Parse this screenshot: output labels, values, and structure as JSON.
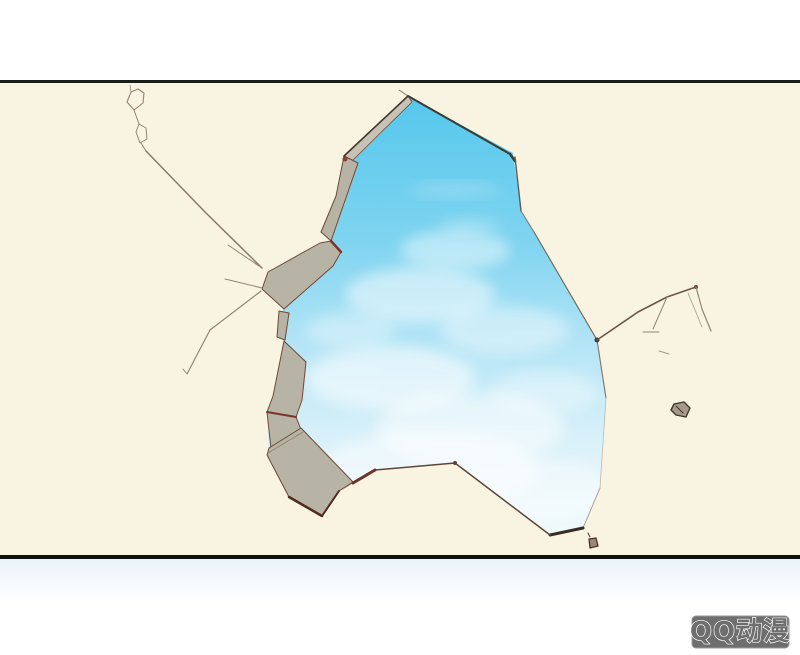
{
  "watermark": {
    "label": "QQ动漫"
  },
  "colors": {
    "page_bg": "#ffffff",
    "panel_bg": "#f9f4e1",
    "frame_line_top": "#1c1c18",
    "frame_line_bottom": "#101010",
    "debris_fill": "#b7b4a6",
    "debris_fill_light": "#c6c2b4",
    "debris_edge": "#6a4a3a",
    "accent_red": "#7a352a",
    "crack": "#948571",
    "cloud": "#ffffff",
    "sky_stops": [
      "#55c7ec",
      "#7fd4f0",
      "#b8e6f6",
      "#ddf2fa",
      "#f0fafd"
    ],
    "band_stops": [
      "#e9f4fa",
      "#ffffff"
    ],
    "watermark_bg": "#6e6e6e",
    "watermark_border": "#9a9a9a",
    "watermark_text": "#ffffff"
  },
  "scene": {
    "hole_points": "410,97 513,153 521,211 534,232 597,340 606,398 600,488 583,528 550,535 455,463 375,470 353,483 339,491 322,516 290,497 268,452 268,412 273,396 284,341 279,337 283,309 333,266 331,241 341,212 344,157",
    "sky_rect": {
      "x": 250,
      "y": 90,
      "w": 370,
      "h": 460
    },
    "clouds": [
      {
        "cx": 455,
        "cy": 190,
        "rx": 45,
        "ry": 5,
        "o": 0.3
      },
      {
        "cx": 470,
        "cy": 225,
        "rx": 30,
        "ry": 6,
        "o": 0.3
      },
      {
        "cx": 455,
        "cy": 250,
        "rx": 55,
        "ry": 20,
        "o": 0.45
      },
      {
        "cx": 420,
        "cy": 295,
        "rx": 75,
        "ry": 28,
        "o": 0.5
      },
      {
        "cx": 505,
        "cy": 330,
        "rx": 65,
        "ry": 24,
        "o": 0.4
      },
      {
        "cx": 350,
        "cy": 330,
        "rx": 45,
        "ry": 18,
        "o": 0.35
      },
      {
        "cx": 390,
        "cy": 378,
        "rx": 85,
        "ry": 32,
        "o": 0.55
      },
      {
        "cx": 545,
        "cy": 392,
        "rx": 55,
        "ry": 22,
        "o": 0.35
      },
      {
        "cx": 470,
        "cy": 428,
        "rx": 95,
        "ry": 36,
        "o": 0.5
      },
      {
        "cx": 430,
        "cy": 470,
        "rx": 110,
        "ry": 40,
        "o": 0.45
      },
      {
        "cx": 530,
        "cy": 490,
        "rx": 90,
        "ry": 32,
        "o": 0.4
      }
    ],
    "shapes": [
      {
        "t": "pg",
        "n": "debris-polygon",
        "p": "408,96 412,102 352,161 344,156",
        "f": "debris_fill_light",
        "s": "debris_edge",
        "w": 0.8
      },
      {
        "t": "pg",
        "n": "debris-polygon",
        "p": "344,156 358,163 341,212 331,241 321,232 336,196",
        "f": "debris_fill",
        "s": "debris_edge",
        "w": 1
      },
      {
        "t": "pg",
        "n": "debris-polygon",
        "p": "331,241 341,252 333,266 284,309 262,289 268,272 320,243",
        "f": "debris_fill",
        "s": "debris_edge",
        "w": 1
      },
      {
        "t": "pg",
        "n": "debris-polygon",
        "p": "279,311 289,313 285,340 277,337",
        "f": "debris_fill",
        "s": "debris_edge",
        "w": 1
      },
      {
        "t": "pg",
        "n": "debris-polygon",
        "p": "284,341 306,362 302,400 296,417 267,412 273,396",
        "f": "debris_fill",
        "s": "debris_edge",
        "w": 1
      },
      {
        "t": "pg",
        "n": "debris-polygon",
        "p": "267,412 296,417 304,437 271,449",
        "f": "debris_fill",
        "s": "debris_edge",
        "w": 1
      },
      {
        "t": "pg",
        "n": "debris-polygon",
        "p": "269,448 301,428 353,482 339,491 322,516 289,497 267,455",
        "f": "debris_fill",
        "s": "debris_edge",
        "w": 1
      },
      {
        "t": "pg",
        "n": "debris-wedge",
        "p": "353,482 372,470 341,491",
        "f": "accent_red",
        "o": 0.85
      },
      {
        "t": "ln",
        "n": "debris-crease",
        "p": [
          268,
          453,
          303,
          432
        ],
        "s": "crack",
        "w": 1
      },
      {
        "t": "ln",
        "n": "hole-edge",
        "p": [
          399,
          90,
          408,
          96
        ],
        "sx": "#8a7a68",
        "w": 1
      },
      {
        "t": "ln",
        "n": "hole-edge",
        "p": [
          408,
          96,
          510,
          154
        ],
        "sx": "#3f3a33",
        "w": 2
      },
      {
        "t": "ln",
        "n": "hole-edge-tick",
        "p": [
          510,
          154,
          515,
          161
        ],
        "sx": "#3f3a33",
        "w": 2.5
      },
      {
        "t": "ln",
        "n": "hole-edge",
        "p": [
          515,
          157,
          521,
          211
        ],
        "sx": "#6b5648",
        "w": 1.4
      },
      {
        "t": "ln",
        "n": "hole-edge",
        "p": [
          521,
          211,
          534,
          232
        ],
        "sx": "#8a7664",
        "w": 1.1
      },
      {
        "t": "ln",
        "n": "hole-edge",
        "p": [
          534,
          232,
          597,
          340
        ],
        "sx": "#7d6853",
        "w": 1.2
      },
      {
        "t": "ln",
        "n": "hole-edge",
        "p": [
          597,
          340,
          606,
          398
        ],
        "sx": "#8d7a66",
        "w": 1.2
      },
      {
        "t": "ln",
        "n": "hole-edge",
        "p": [
          606,
          398,
          600,
          488
        ],
        "sx": "#c3b6a6",
        "w": 0.8
      },
      {
        "t": "ln",
        "n": "hole-edge",
        "p": [
          600,
          488,
          583,
          528
        ],
        "sx": "#b3a290",
        "w": 1
      },
      {
        "t": "ln",
        "n": "hole-edge",
        "p": [
          583,
          528,
          550,
          535
        ],
        "sx": "#3a2b24",
        "w": 3
      },
      {
        "t": "pl",
        "n": "hole-edge",
        "p": "550,535 455,463 375,470",
        "sx": "#5f4537",
        "w": 1.5
      },
      {
        "t": "ln",
        "n": "hole-edge",
        "p": [
          375,
          470,
          353,
          483
        ],
        "sx": "#6e3226",
        "w": 3
      },
      {
        "t": "ln",
        "n": "hole-edge",
        "p": [
          408,
          96,
          344,
          156
        ],
        "sx": "#46362e",
        "w": 1.6
      },
      {
        "t": "ln",
        "n": "debris-accent",
        "p": [
          331,
          241,
          341,
          252
        ],
        "s": "accent_red",
        "w": 2.5
      },
      {
        "t": "ln",
        "n": "debris-accent",
        "p": [
          267,
          412,
          296,
          417
        ],
        "s": "accent_red",
        "w": 2
      },
      {
        "t": "ln",
        "n": "debris-accent",
        "p": [
          289,
          497,
          322,
          516
        ],
        "sx": "#502a20",
        "w": 2.5
      },
      {
        "t": "ln",
        "n": "debris-accent",
        "p": [
          322,
          516,
          339,
          491
        ],
        "sx": "#502a20",
        "w": 2
      },
      {
        "t": "c",
        "n": "debris-accent-dot",
        "p": [
          345,
          159,
          2.5
        ],
        "fx": "#8a4034"
      },
      {
        "t": "c",
        "n": "edge-node-dot",
        "p": [
          455,
          463,
          2
        ],
        "fx": "#5f4537"
      },
      {
        "t": "c",
        "n": "edge-node-dot",
        "p": [
          597,
          340,
          2.5
        ],
        "fx": "#4a332c"
      },
      {
        "t": "c",
        "n": "edge-node-dot",
        "p": [
          696,
          287,
          2
        ],
        "fx": "#7a352a"
      },
      {
        "t": "ln",
        "n": "crack-line",
        "p": [
          131,
          92,
          130,
          85
        ],
        "s": "crack",
        "w": 0.8
      },
      {
        "t": "pl",
        "n": "crack-loop",
        "p": "131,92 138,89 144,93 143,103 134,110 127,102 131,92",
        "s": "crack",
        "w": 1.1
      },
      {
        "t": "ln",
        "n": "crack-line",
        "p": [
          134,
          110,
          139,
          124
        ],
        "s": "crack",
        "w": 1
      },
      {
        "t": "pl",
        "n": "crack-loop",
        "p": "139,124 146,128 147,139 140,143 136,132 139,124",
        "s": "crack",
        "w": 1
      },
      {
        "t": "ln",
        "n": "crack-line",
        "p": [
          141,
          143,
          146,
          151
        ],
        "s": "crack",
        "w": 1
      },
      {
        "t": "pl",
        "n": "crack-line-long",
        "p": "146,151 205,212 262,268",
        "sx": "#8a7a68",
        "w": 1.5
      },
      {
        "t": "ln",
        "n": "crack-line",
        "p": [
          262,
          268,
          228,
          245
        ],
        "s": "crack",
        "w": 1
      },
      {
        "t": "ln",
        "n": "crack-line",
        "p": [
          262,
          288,
          225,
          279
        ],
        "s": "crack",
        "w": 1
      },
      {
        "t": "pl",
        "n": "crack-line",
        "p": "261,291 210,330 187,374",
        "s": "crack",
        "w": 1.2
      },
      {
        "t": "ln",
        "n": "crack-line",
        "p": [
          187,
          374,
          183,
          369
        ],
        "s": "crack",
        "w": 1
      },
      {
        "t": "pl",
        "n": "crack-line-right",
        "p": "597,340 638,312 667,297 696,287",
        "sx": "#6b584a",
        "w": 1.6
      },
      {
        "t": "pl",
        "n": "crack-line-right",
        "p": "696,287 702,309 711,331",
        "s": "crack",
        "w": 1.2
      },
      {
        "t": "ln",
        "n": "crack-line-right",
        "p": [
          667,
          297,
          653,
          329
        ],
        "s": "crack",
        "w": 1
      },
      {
        "t": "ln",
        "n": "crack-line-right",
        "p": [
          643,
          332,
          659,
          332
        ],
        "s": "crack",
        "w": 1
      },
      {
        "t": "ln",
        "n": "crack-line-right",
        "p": [
          688,
          293,
          702,
          327
        ],
        "sx": "#a79a88",
        "w": 0.8
      },
      {
        "t": "ln",
        "n": "crack-line-right",
        "p": [
          659,
          351,
          669,
          354
        ],
        "sx": "#a79a88",
        "w": 1
      },
      {
        "t": "pg",
        "n": "debris-speck",
        "p": "589,539 596,538 598,546 590,548",
        "fx": "#9a8878",
        "sx": "#4a332c",
        "w": 1.3
      },
      {
        "t": "ln",
        "n": "debris-speck-tick",
        "p": [
          588,
          533,
          590,
          537
        ],
        "sx": "#4a332c",
        "w": 1
      },
      {
        "t": "pg",
        "n": "debris-pebble",
        "p": "674,404 684,402 690,408 686,417 676,415 671,410",
        "fx": "#a89a8a",
        "sx": "#3f362e",
        "w": 1.4
      },
      {
        "t": "ln",
        "n": "debris-pebble-crease",
        "p": [
          676,
          406,
          683,
          413
        ],
        "sx": "#3f362e",
        "w": 1
      }
    ]
  }
}
